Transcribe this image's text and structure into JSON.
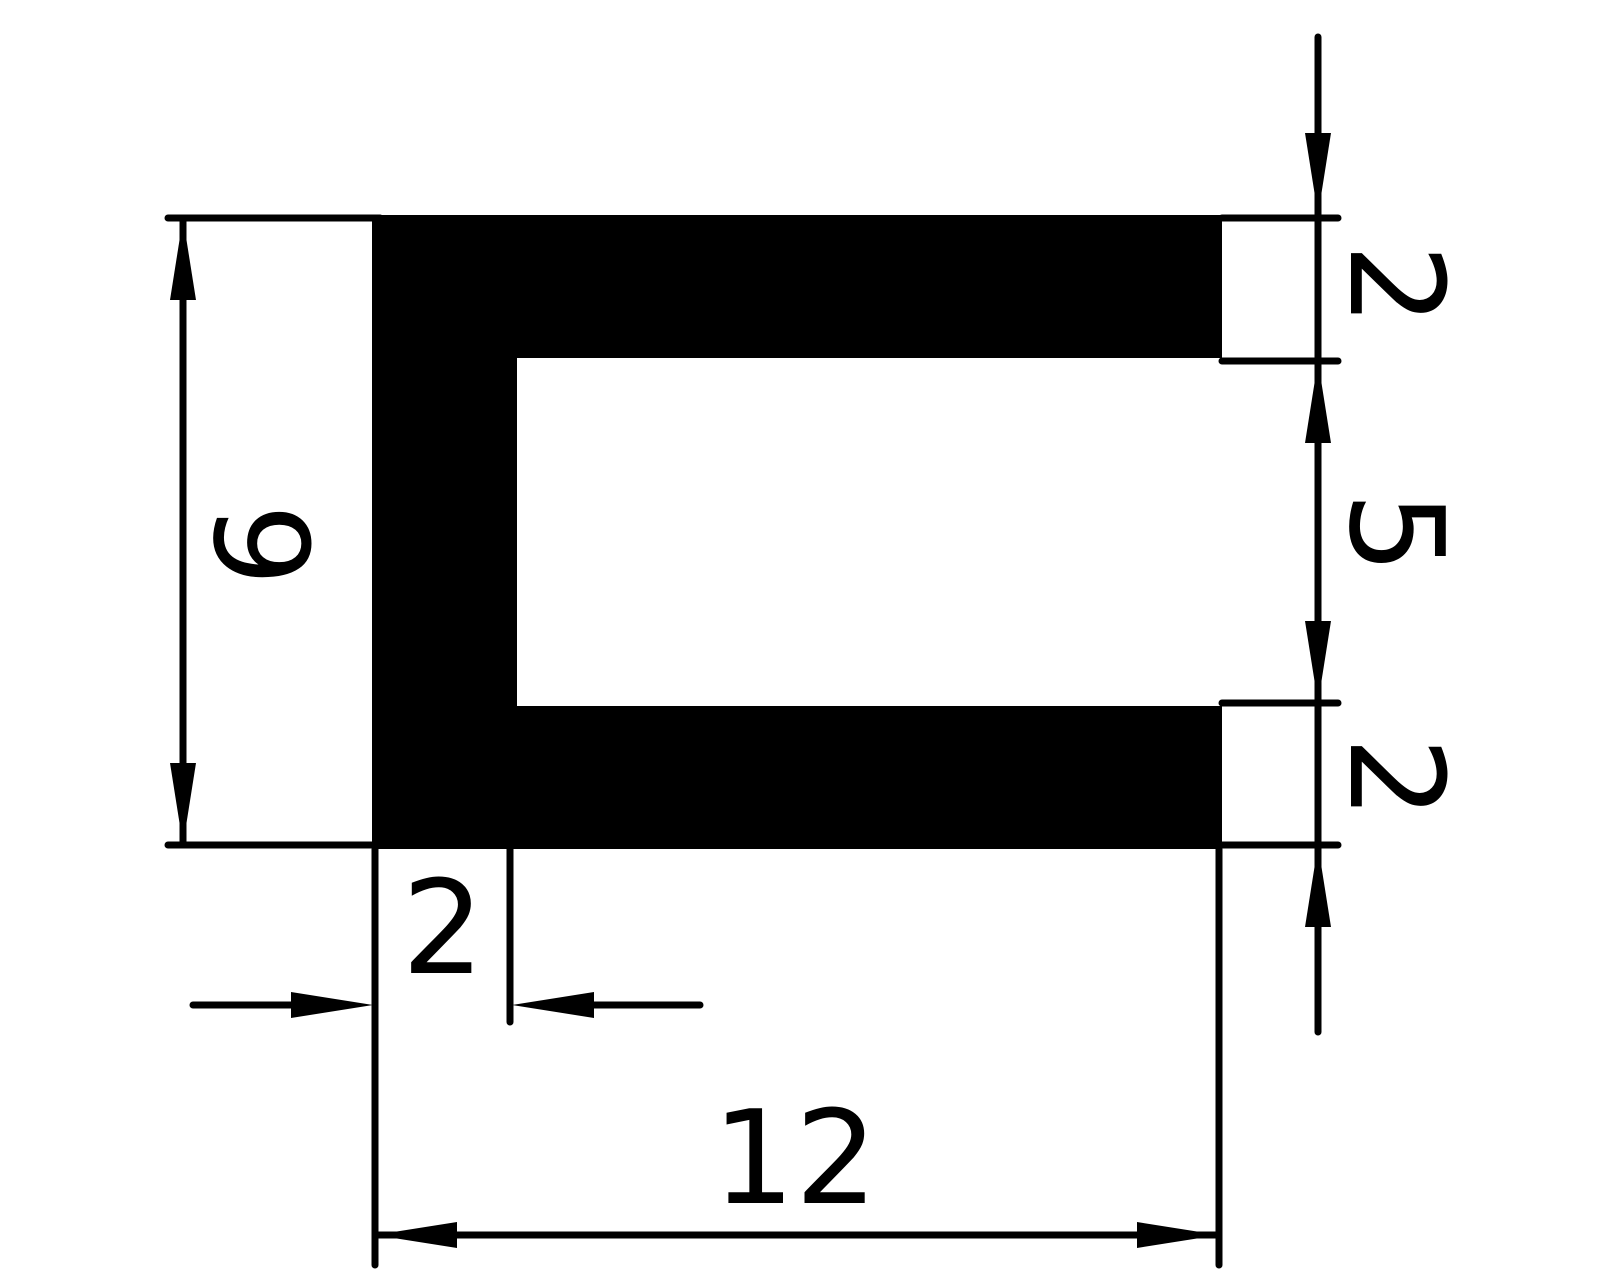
{
  "drawing": {
    "background_color": "#ffffff",
    "line_color": "#000000",
    "fill_color": "#000000",
    "labels": {
      "height": "9",
      "top_flange": "2",
      "opening": "5",
      "bottom_flange": "2",
      "wall": "2",
      "width": "12"
    }
  }
}
